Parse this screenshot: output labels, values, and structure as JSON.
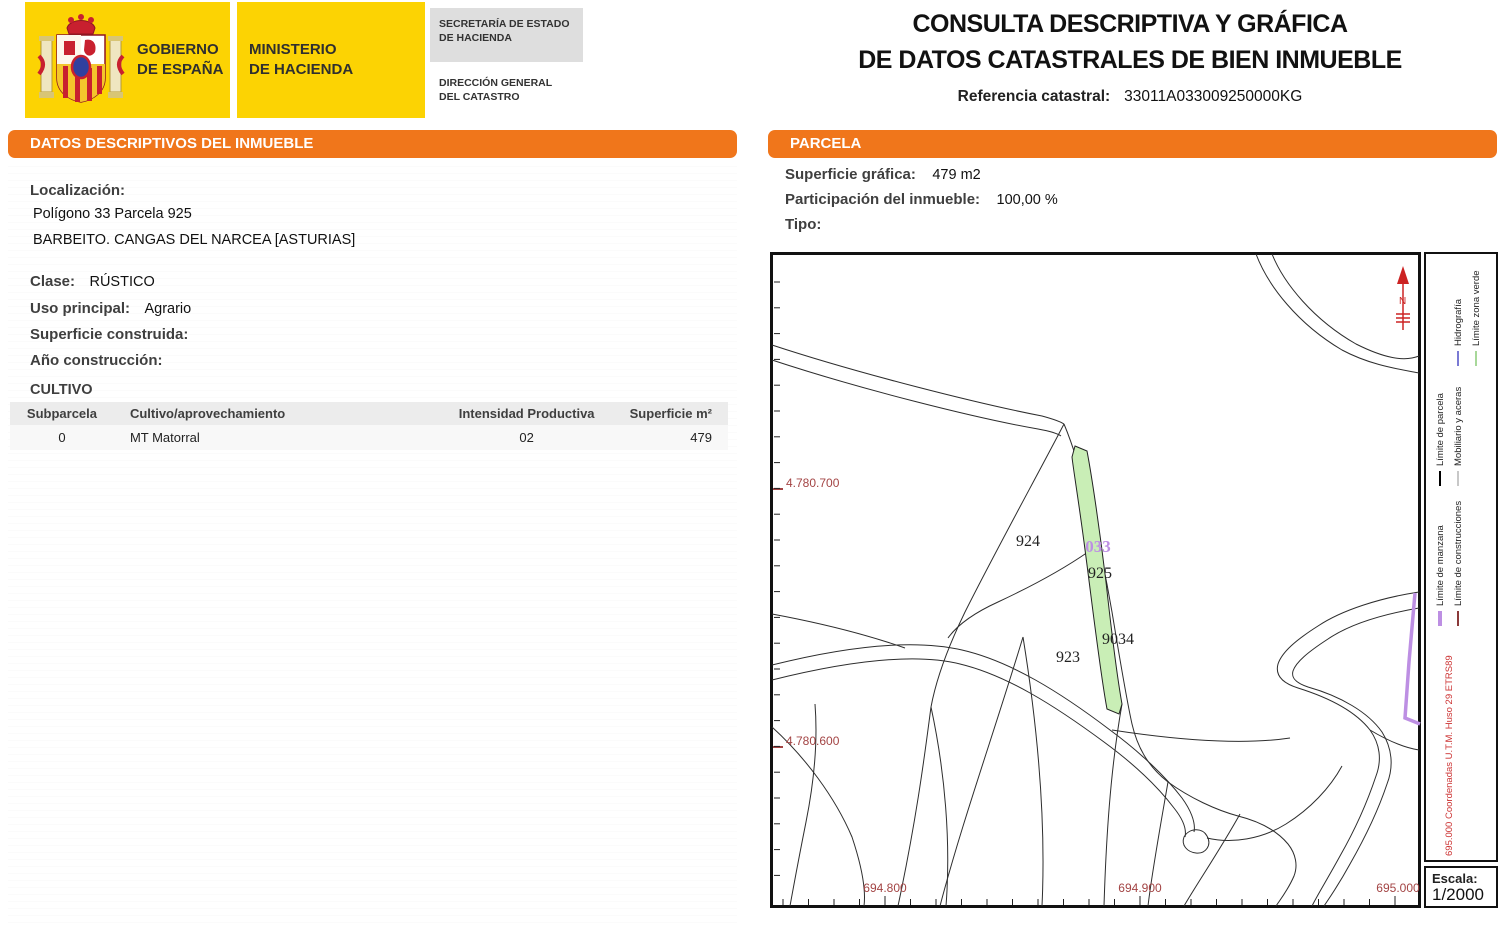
{
  "header": {
    "gobierno_line1": "GOBIERNO",
    "gobierno_line2": "DE ESPAÑA",
    "ministerio_line1": "MINISTERIO",
    "ministerio_line2": "DE HACIENDA",
    "secretaria_line1": "SECRETARÍA DE ESTADO",
    "secretaria_line2": "DE HACIENDA",
    "direccion_line1": "DIRECCIÓN GENERAL",
    "direccion_line2": "DEL CATASTRO"
  },
  "title": {
    "line1": "CONSULTA DESCRIPTIVA Y GRÁFICA",
    "line2": "DE DATOS CATASTRALES DE BIEN INMUEBLE",
    "ref_label": "Referencia catastral:",
    "ref_value": "33011A033009250000KG"
  },
  "left_panel": {
    "header": "DATOS DESCRIPTIVOS DEL INMUEBLE",
    "localizacion_label": "Localización:",
    "localizacion_line1": "Polígono 33 Parcela 925",
    "localizacion_line2": "BARBEITO. CANGAS DEL NARCEA [ASTURIAS]",
    "clase_label": "Clase:",
    "clase_value": "RÚSTICO",
    "uso_label": "Uso principal:",
    "uso_value": "Agrario",
    "superficie_label": "Superficie construida:",
    "superficie_value": "",
    "anio_label": "Año construcción:",
    "anio_value": "",
    "cultivo": {
      "title": "CULTIVO",
      "columns": [
        "Subparcela",
        "Cultivo/aprovechamiento",
        "Intensidad Productiva",
        "Superficie m²"
      ],
      "rows": [
        [
          "0",
          "MT Matorral",
          "02",
          "479"
        ]
      ]
    }
  },
  "parcela_panel": {
    "header": "PARCELA",
    "superficie_label": "Superficie gráfica:",
    "superficie_value": "479 m2",
    "participacion_label": "Participación del inmueble:",
    "participacion_value": "100,00 %",
    "tipo_label": "Tipo:",
    "tipo_value": ""
  },
  "map": {
    "labels": [
      {
        "text": "924"
      },
      {
        "text": "033"
      },
      {
        "text": "925"
      },
      {
        "text": "9034"
      },
      {
        "text": "923"
      }
    ],
    "x_axis_labels": [
      "694.800",
      "694.900",
      "695.000"
    ],
    "y_axis_labels": [
      "4.780.700",
      "4.780.600"
    ],
    "north": "N"
  },
  "legend": {
    "entries": [
      {
        "label": "Límite de parcela",
        "color": "#000000"
      },
      {
        "label": "Límite de manzana",
        "color": "#BD8FE3"
      },
      {
        "label": "Hidrografía",
        "color": "#7A7AD4"
      },
      {
        "label": "Mobiliario y aceras",
        "color": "#C8C8C8"
      },
      {
        "label": "Límite de construcciones",
        "color": "#8B3A3A"
      },
      {
        "label": "Límite zona verde",
        "color": "#A8D89A"
      }
    ],
    "coords_note": "695.000 Coordenadas U.T.M. Huso 29 ETRS89",
    "escala_label": "Escala:",
    "escala_value": "1/2000"
  },
  "colors": {
    "orange_bar": "#F0761B",
    "gov_yellow": "#FCD303",
    "coord_text": "#A34444",
    "selected_parcel_green": "#C9EEB6",
    "manzana_purple": "#BD8FE3"
  }
}
